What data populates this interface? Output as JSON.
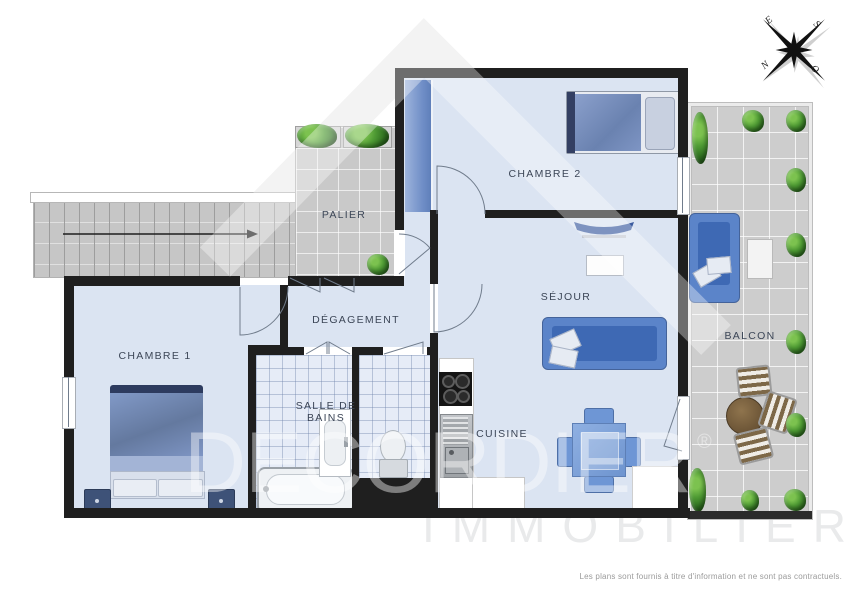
{
  "page": {
    "footer_note": "Les plans sont fournis à titre d'information et ne sont pas contractuels."
  },
  "watermark": {
    "brand": "DECORDIER",
    "registered_mark": "®",
    "subtitle": "IMMOBILIER"
  },
  "compass": {
    "e": "E",
    "s": "S",
    "n": "N",
    "o": "O"
  },
  "rooms": {
    "palier": "PALIER",
    "chambre2": "CHAMBRE 2",
    "sejour": "SÉJOUR",
    "degagement": "DÉGAGEMENT",
    "chambre1": "CHAMBRE 1",
    "salle_de_bains": {
      "line1": "SALLE DE",
      "line2": "BAINS"
    },
    "cuisine": "CUISINE",
    "balcon": "BALCON"
  },
  "colors": {
    "wall": "#1f1f1f",
    "room_floor": "#dbe4f2",
    "bath_floor": "#e6ecf7",
    "common_tile": "#c9c9c9",
    "balcony_tile": "#cdcdcd",
    "furniture_blue": "#5b84c9",
    "furniture_blue_dark": "#3e69b4",
    "plant_green": "#4f9b34",
    "label_text": "#3c4657",
    "watermark_gray": "#e9eaeb"
  },
  "furniture_icons": [
    "stairs",
    "double-bed",
    "single-bed",
    "wardrobe",
    "sofa",
    "tv",
    "coffee-table",
    "dining-table",
    "chair",
    "cooktop",
    "kitchen-sink",
    "counter",
    "bathtub",
    "washbasin",
    "toilet",
    "outdoor-sofa",
    "outdoor-side-table",
    "round-wood-table",
    "wood-chair",
    "plant",
    "compass-rose",
    "house-roof-logo"
  ]
}
